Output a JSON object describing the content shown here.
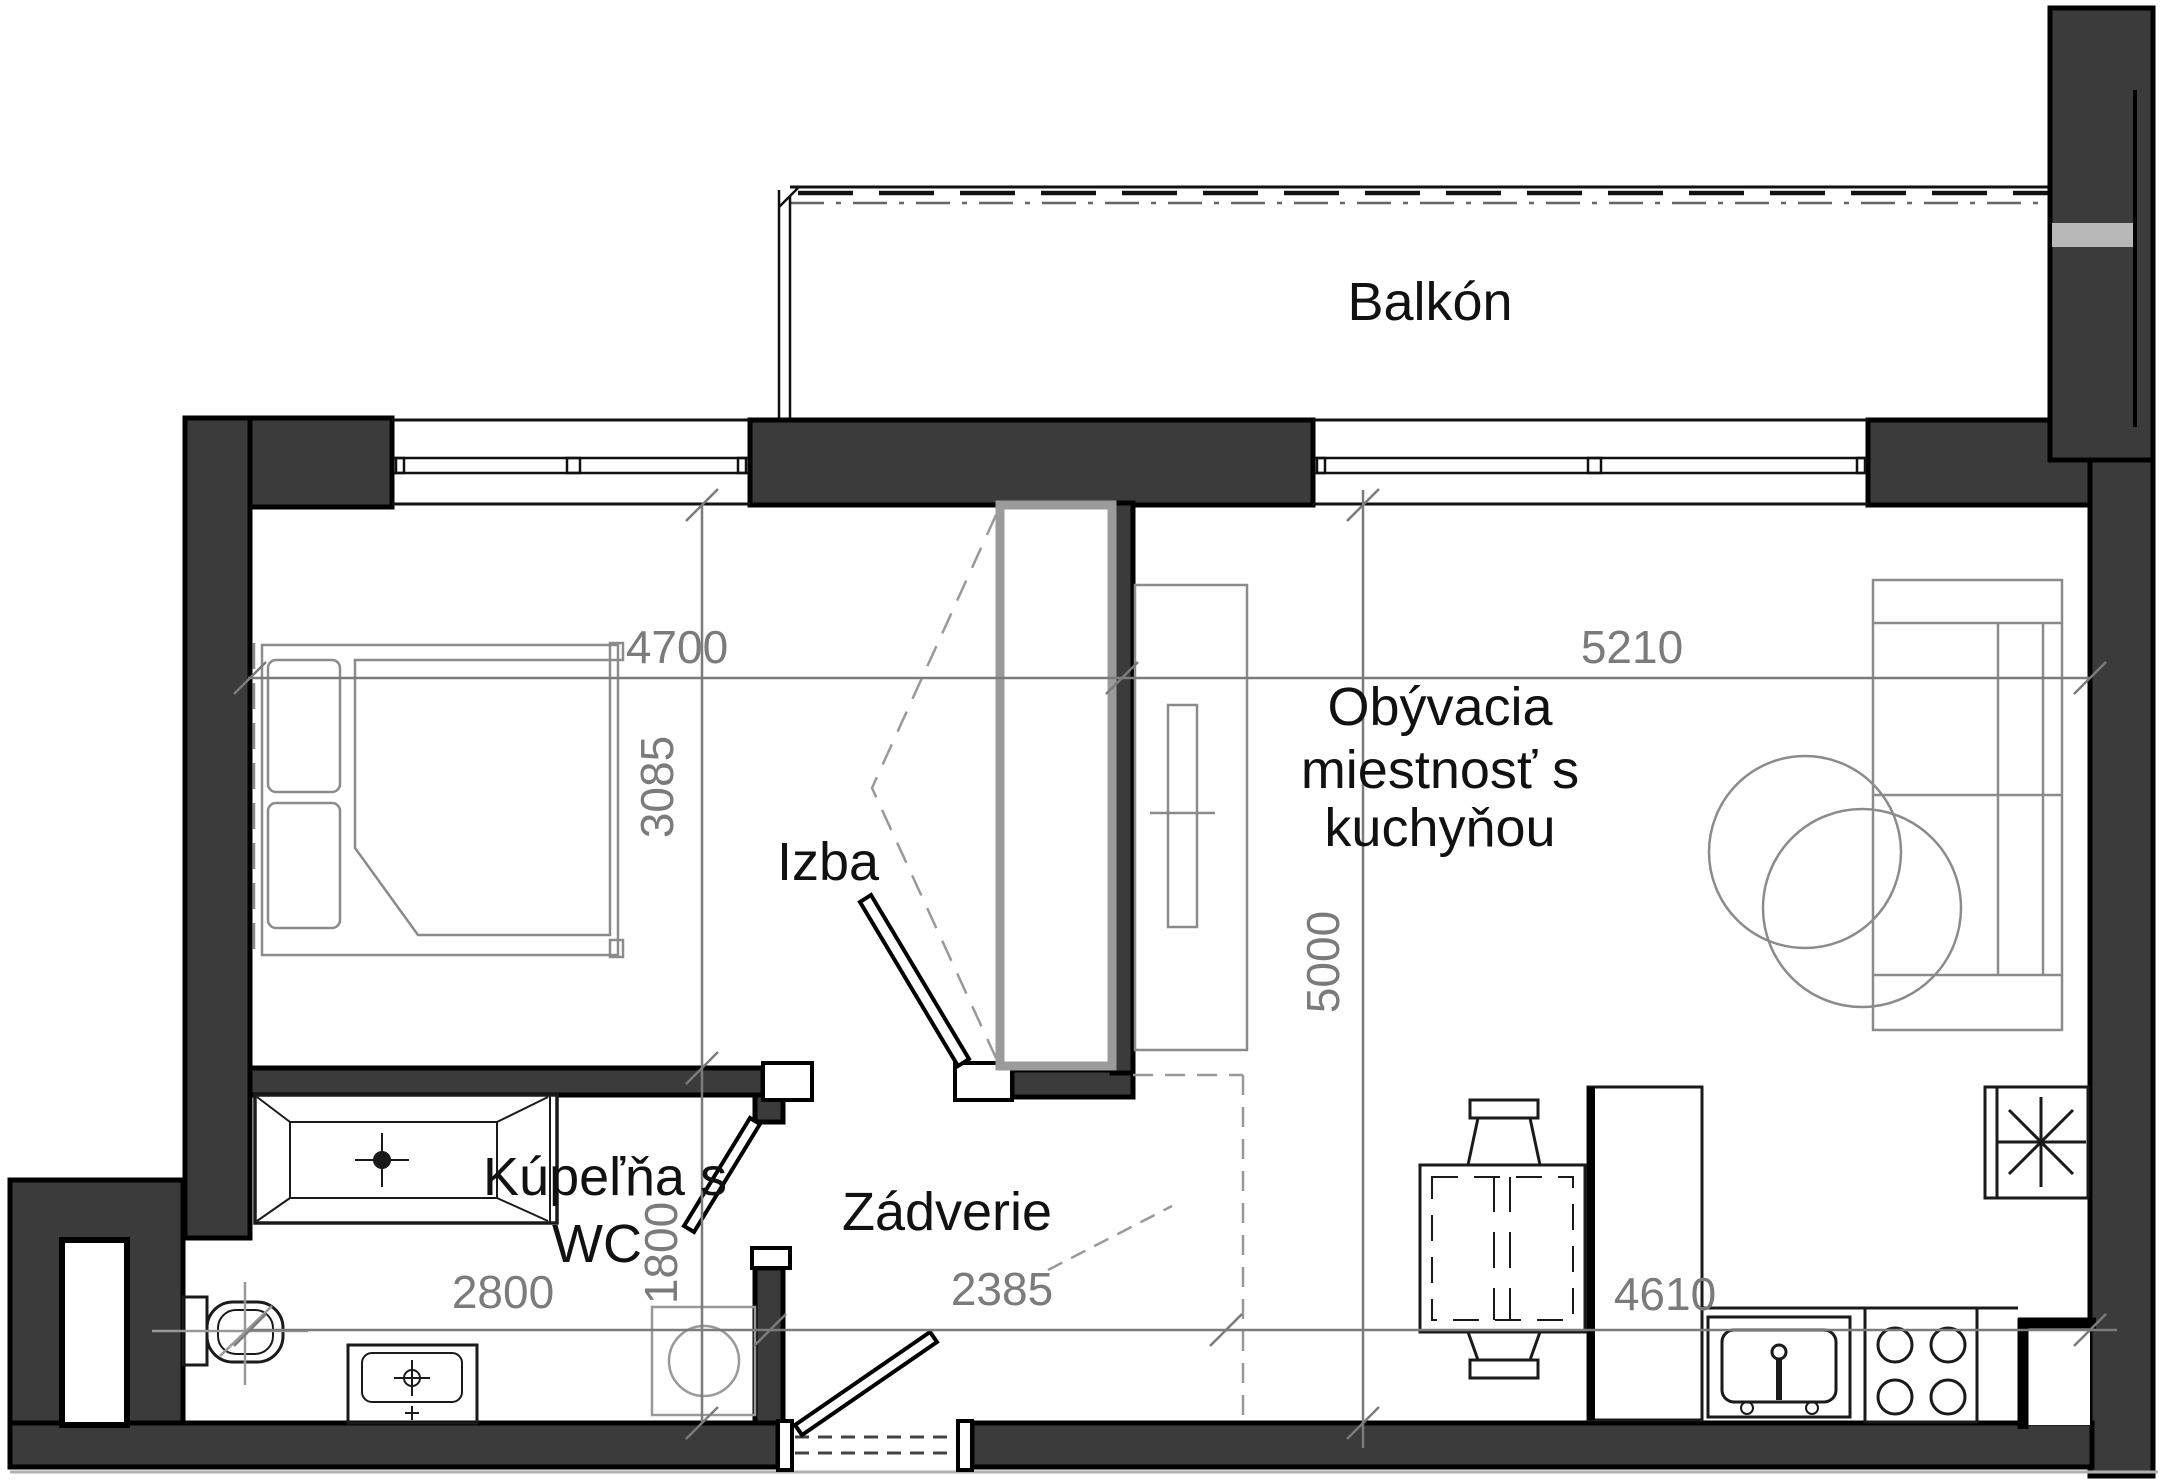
{
  "page": {
    "background": "#ffffff",
    "type": "apartment-floor-plan"
  },
  "colors": {
    "wall": "#3b3b3b",
    "outline": "#000000",
    "dimension": "#7b7b7b",
    "label": "#111111",
    "furniture": "#8b8b8b",
    "light_band": "#b8b8b8"
  },
  "rooms": {
    "balcony": {
      "label": "Balkón"
    },
    "bedroom": {
      "label": "Izba"
    },
    "living": {
      "label_line1": "Obývacia",
      "label_line2": "miestnosť s",
      "label_line3": "kuchyňou"
    },
    "bathroom": {
      "label_line1": "Kúpeľňa s",
      "label_line2": "WC"
    },
    "hall": {
      "label": "Zádverie"
    }
  },
  "dimensions": {
    "bedroom_width": "4700",
    "bedroom_depth": "3085",
    "living_width": "5210",
    "living_depth": "5000",
    "bathroom_width": "2800",
    "bathroom_depth": "1800",
    "hall_width": "2385",
    "kitchen_run": "4610"
  }
}
